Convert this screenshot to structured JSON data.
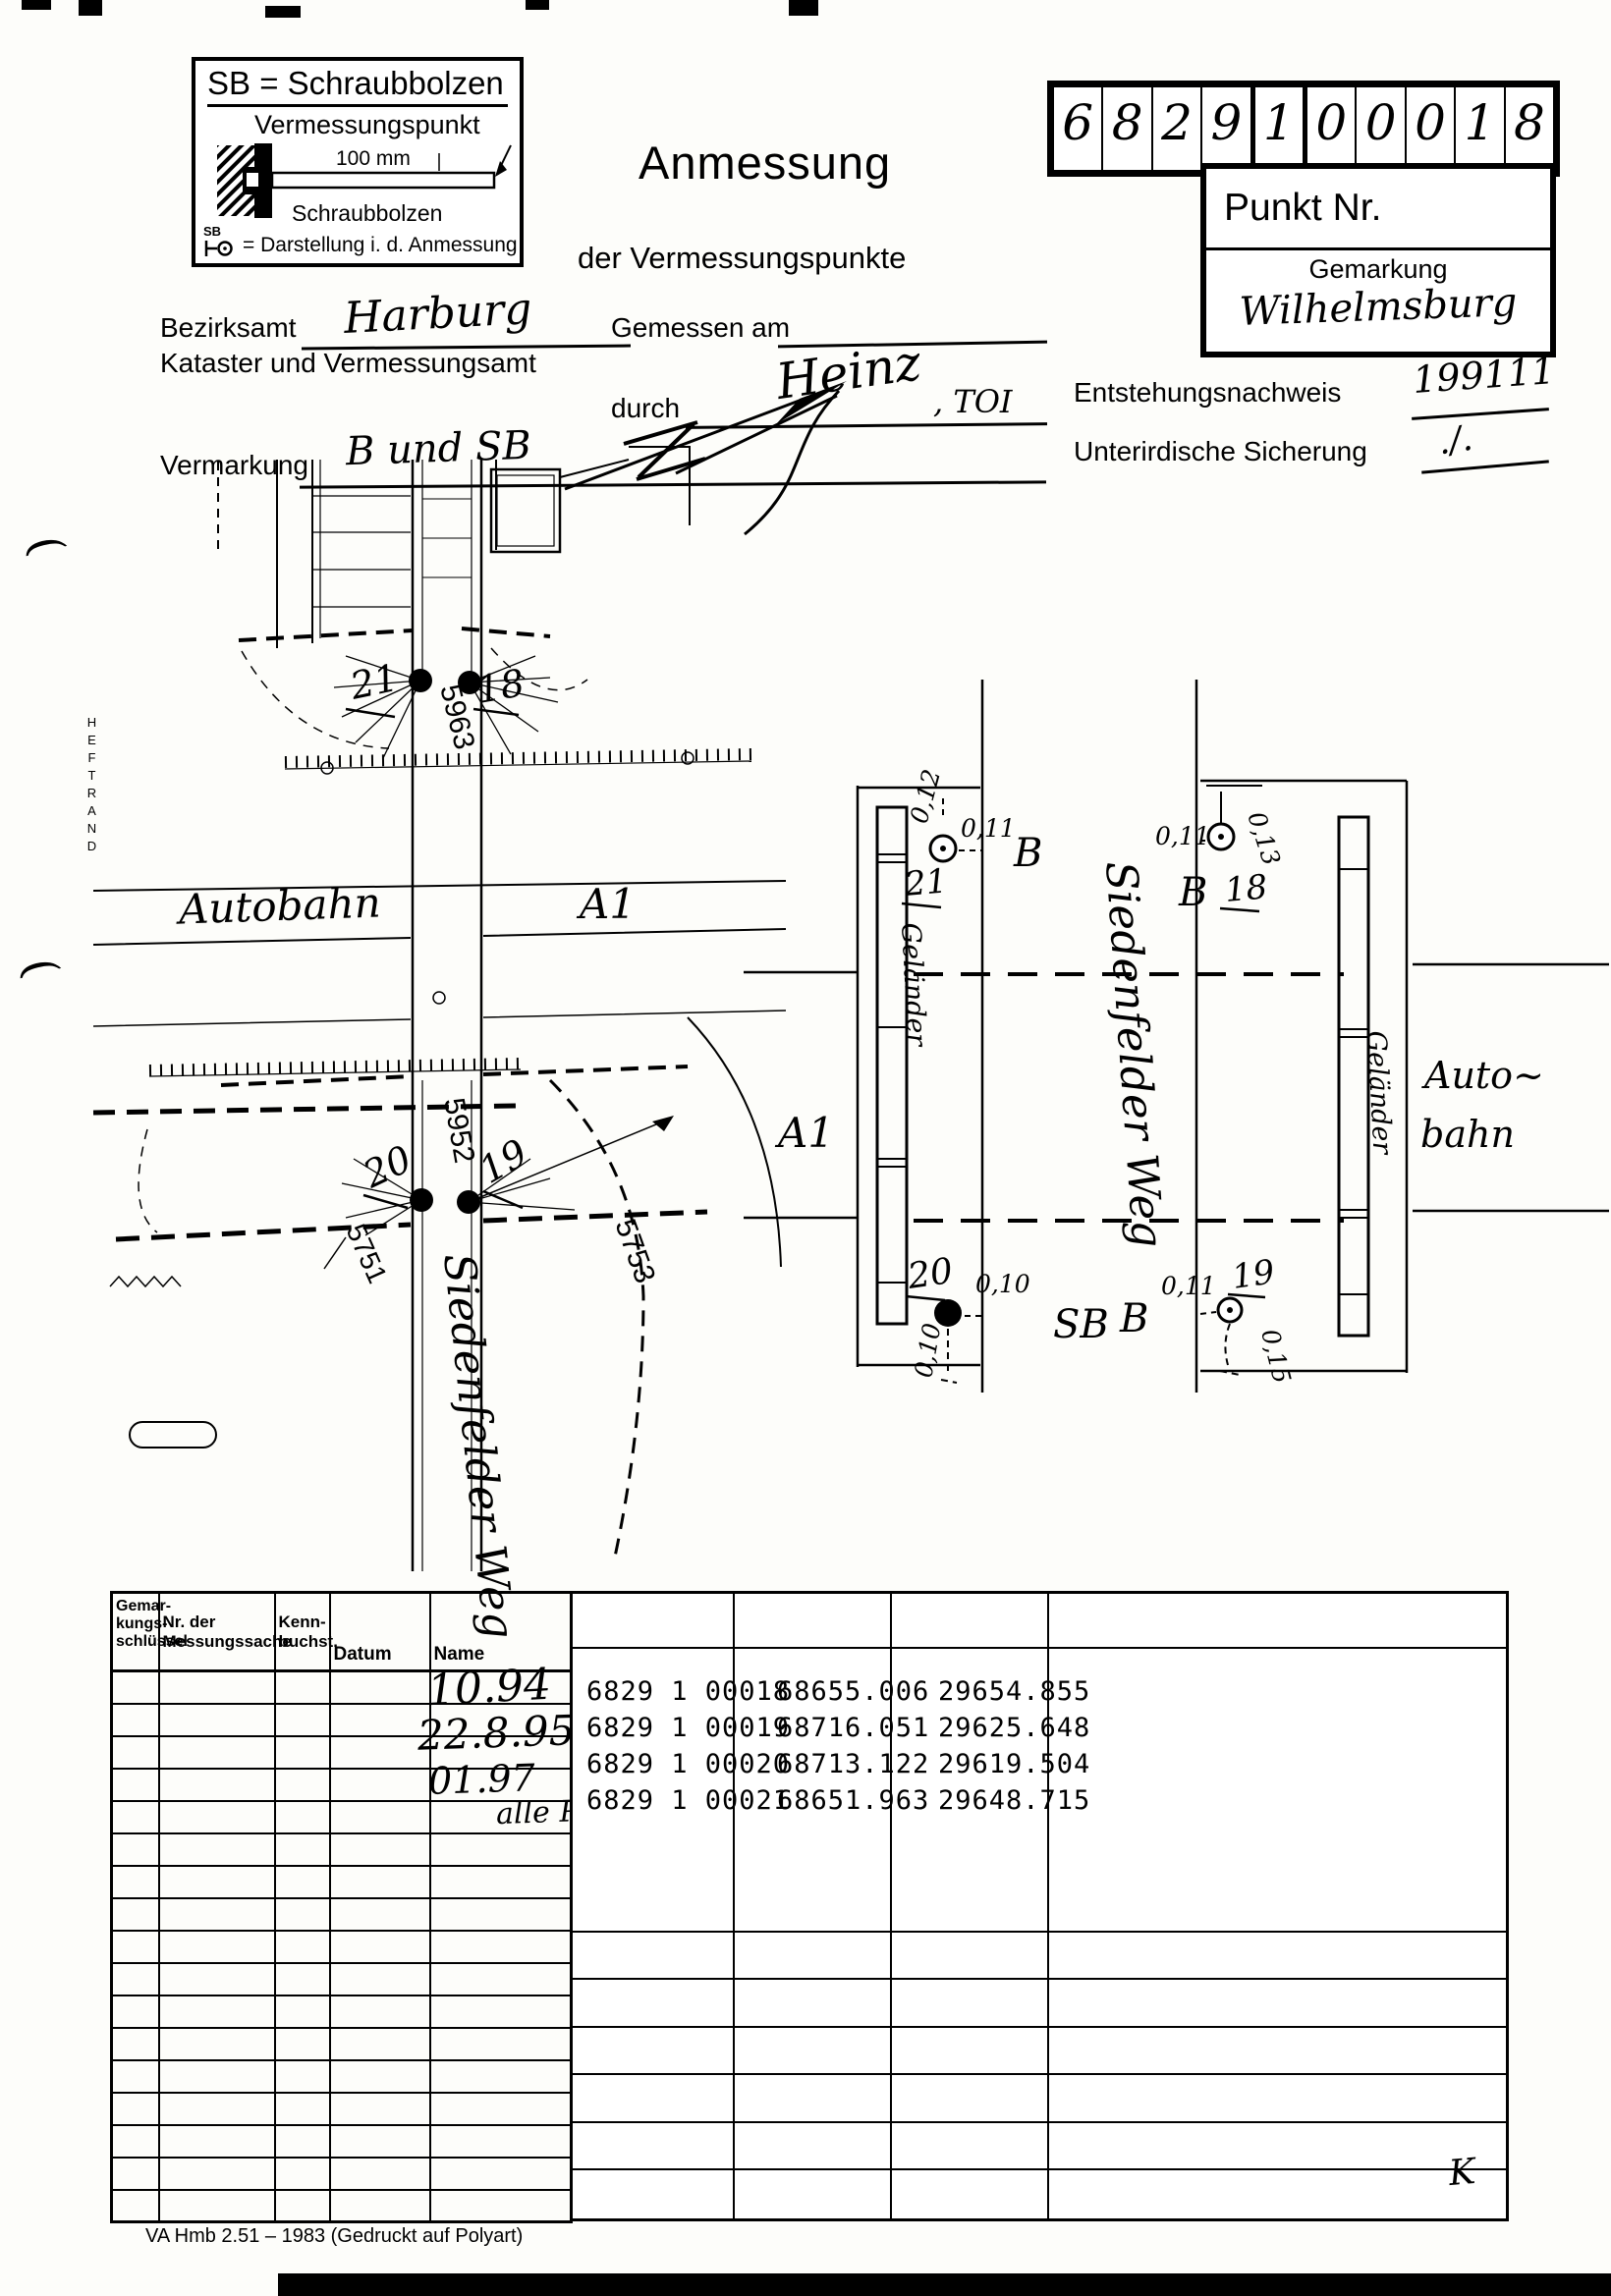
{
  "document": {
    "footer": "VA Hmb 2.51 – 1983 (Gedruckt auf Polyart)",
    "heftrand": "HEFTRAND",
    "corner_mark": "K",
    "margin_mark": "("
  },
  "legend": {
    "title": "SB = Schraubbolzen",
    "point_label": "Vermessungspunkt",
    "dimension": "100 mm",
    "bolt_label": "Schraubbolzen",
    "symbol_sb": "SB",
    "symbol_desc": "= Darstellung i. d. Anmessung"
  },
  "title": {
    "line1": "Anmessung",
    "line2": "der Vermessungspunkte"
  },
  "point_number": {
    "digits": [
      "6",
      "8",
      "2",
      "9",
      "1",
      "0",
      "0",
      "0",
      "1",
      "8"
    ],
    "label": "Punkt Nr.",
    "gemarkung_label": "Gemarkung",
    "gemarkung_value": "Wilhelmsburg"
  },
  "form": {
    "bezirksamt_label": "Bezirksamt",
    "bezirksamt_value": "Harburg",
    "kataster_label": "Kataster und Vermessungsamt",
    "gemessen_label": "Gemessen am",
    "durch_label": "durch",
    "durch_value_name": "Heinz",
    "durch_value_title": ", TOI",
    "entstehung_label": "Entstehungsnachweis",
    "entstehung_value": "199111",
    "vermarkung_label": "Vermarkung",
    "vermarkung_value": "B  und  SB",
    "sicherung_label": "Unterirdische Sicherung",
    "sicherung_value": "./."
  },
  "map": {
    "autobahn": "Autobahn",
    "a1": "A1",
    "street": "Siedenfelder Weg",
    "parcels": [
      "5963",
      "5952",
      "5751",
      "5753"
    ],
    "points": {
      "p21": "21",
      "p18": "18",
      "p20": "20",
      "p19": "19"
    }
  },
  "sketch": {
    "gelaender": "Geländer",
    "street": "Siedenfelder Weg",
    "auto_line1": "Auto~",
    "auto_line2": "bahn",
    "a1": "A1",
    "p21": {
      "id": "21",
      "offset_left": "0,12",
      "offset_right": "0,11",
      "mark": "B"
    },
    "p18": {
      "id": "18",
      "offset_left": "0,11",
      "offset_right": "0,13",
      "mark": "B"
    },
    "p20": {
      "id": "20",
      "offset_right": "0,10",
      "offset_below": "0,10",
      "mark": "SB"
    },
    "p19": {
      "id": "19",
      "offset_left": "0,11",
      "offset_below": "0,15",
      "mark": "B"
    }
  },
  "history_table": {
    "headers": {
      "col1": [
        "Gemar-",
        "kungs-",
        "schlüssel"
      ],
      "col2": [
        "Nr. der",
        "Messungssache"
      ],
      "col3": [
        "Kenn-",
        "buchst."
      ],
      "col4": "Datum",
      "col5": "Name"
    },
    "row_count": 17,
    "entries": [
      {
        "datum": "10.94",
        "name": "alle Punkte vgl Liste"
      },
      {
        "datum": "22.8.95",
        "name": "alle Pkt auf Leitpl."
      },
      {
        "datum": "01.97",
        "name_struck": "20",
        "name": " auf Stahlbuhk"
      },
      {
        "datum": "",
        "name": "alle Pkt."
      }
    ]
  },
  "coordinates": {
    "rows": [
      {
        "point": "6829 1 00018",
        "x": "68655.006",
        "y": "29654.855"
      },
      {
        "point": "6829 1 00019",
        "x": "68716.051",
        "y": "29625.648"
      },
      {
        "point": "6829 1 00020",
        "x": "68713.122",
        "y": "29619.504"
      },
      {
        "point": "6829 1 00021",
        "x": "68651.963",
        "y": "29648.715"
      }
    ]
  }
}
